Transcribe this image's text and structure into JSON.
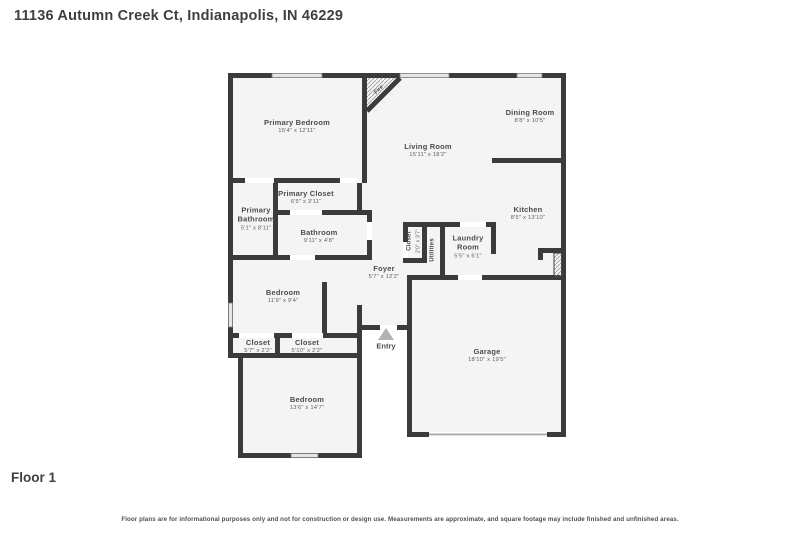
{
  "header": {
    "title": "11136 Autumn Creek Ct, Indianapolis, IN 46229"
  },
  "floor_label": "Floor 1",
  "disclaimer": "Floor plans are for informational purposes only and not for construction or design use. Measurements are approximate, and square footage may include finished and unfinished areas.",
  "colors": {
    "wall": "#3b3b3b",
    "floor": "#f4f4f4",
    "background": "#ffffff",
    "label_text": "#4d4d4d",
    "dims_text": "#5e5e5e"
  },
  "rooms": {
    "primary_bedroom": {
      "name": "Primary Bedroom",
      "dims": "15'4\" x 12'11\""
    },
    "living_room": {
      "name": "Living Room",
      "dims": "15'11\" x 18'2\""
    },
    "dining_room": {
      "name": "Dining Room",
      "dims": "8'8\" x 10'5\""
    },
    "kitchen": {
      "name": "Kitchen",
      "dims": "8'5\" x 13'10\""
    },
    "primary_closet": {
      "name": "Primary Closet",
      "dims": "6'5\" x 3'11\""
    },
    "primary_bathroom": {
      "name": "Primary Bathroom",
      "dims": "5'1\" x 8'11\""
    },
    "bathroom": {
      "name": "Bathroom",
      "dims": "9'11\" x 4'8\""
    },
    "hall_closet": {
      "name": "Closet",
      "dims": "2'0\" x 3'7\""
    },
    "utilities": {
      "name": "Utilities"
    },
    "laundry_room": {
      "name": "Laundry Room",
      "dims": "5'5\" x 6'1\""
    },
    "foyer": {
      "name": "Foyer",
      "dims": "5'7\" x 12'2\""
    },
    "bedroom_mid": {
      "name": "Bedroom",
      "dims": "11'9\" x 9'4\""
    },
    "closet_left": {
      "name": "Closet",
      "dims": "5'7\" x 2'2\""
    },
    "closet_right": {
      "name": "Closet",
      "dims": "5'10\" x 2'2\""
    },
    "entry": {
      "name": "Entry"
    },
    "garage": {
      "name": "Garage",
      "dims": "18'10\" x 19'5\""
    },
    "bedroom_bottom": {
      "name": "Bedroom",
      "dims": "13'6\" x 14'7\""
    },
    "fireplace": {
      "name": "Fire"
    }
  }
}
